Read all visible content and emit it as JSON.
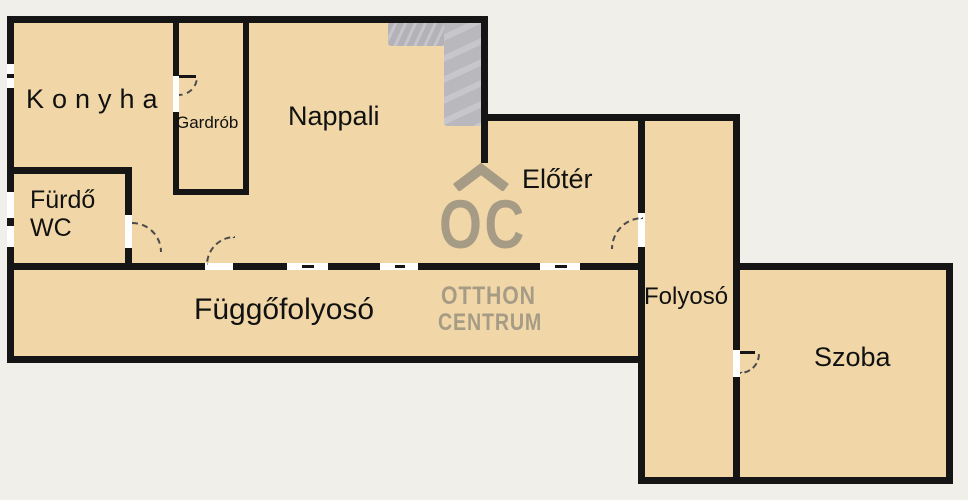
{
  "plan": {
    "title": "Apartment floor plan",
    "rooms": {
      "konyha": {
        "label": "Konyha"
      },
      "gardrob": {
        "label": "Gardrób"
      },
      "nappali": {
        "label": "Nappali"
      },
      "furdo_wc": {
        "label": "Fürdő WC",
        "line1": "Fürdő",
        "line2": "WC"
      },
      "eloter": {
        "label": "Előtér"
      },
      "fuggofolyoso": {
        "label": "Függőfolyosó"
      },
      "folyoso": {
        "label": "Folyosó"
      },
      "szoba": {
        "label": "Szoba"
      }
    }
  },
  "watermark": {
    "logo_text": "OC",
    "line1": "OTTHON",
    "line2": "CENTRUM"
  },
  "colors": {
    "floor": "#f1d7a7",
    "wall": "#151515",
    "background": "#f1efe9",
    "watermark": "#a69c86",
    "stairs": "#b7b7bb",
    "stairs_light": "#c6c6ca",
    "opening_white": "#ffffff"
  }
}
